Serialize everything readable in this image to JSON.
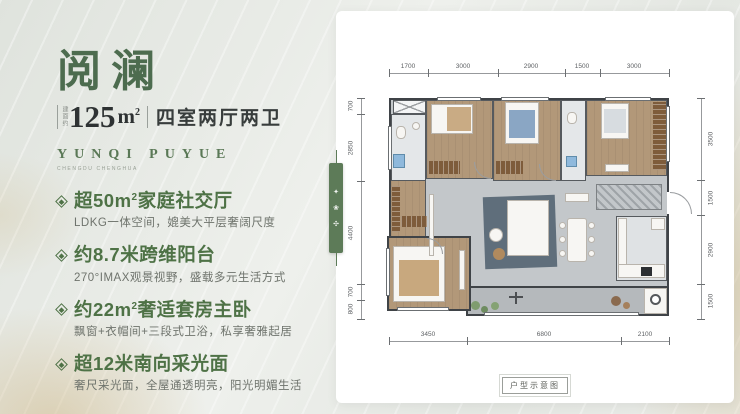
{
  "colors": {
    "accent_green": "#4e7246",
    "title_green": "#4d6c4f",
    "tab_green": "#5d7b58",
    "gold": "#c6a86c",
    "wood_floor": "#b29879",
    "living_gray": "#c3c7ca",
    "balcony_gray": "#b5b9bc",
    "wall_dark": "#3f4347"
  },
  "left_panel": {
    "title": "阅澜",
    "area_prefix": "建面约",
    "area_value": "125",
    "area_unit": "m",
    "area_sup": "2",
    "rooms_text": "四室两厅两卫",
    "subtitle_en": "YUNQI PUYUE",
    "subtitle_sub": "CHENGDU CHENGHUA",
    "features": [
      {
        "t1": "超50m",
        "sup": "2",
        "t2": "家庭社交厅",
        "desc": "LDKG一体空间，媲美大平层奢阔尺度"
      },
      {
        "t1": "约8.7米跨维阳台",
        "sup": "",
        "t2": "",
        "desc": "270°IMAX观景视野，盛载多元生活方式"
      },
      {
        "t1": "约22m",
        "sup": "2",
        "t2": "奢适套房主卧",
        "desc": "飘窗+衣帽间+三段式卫浴，私享奢雅起居"
      },
      {
        "t1": "超12米南向采光面",
        "sup": "",
        "t2": "",
        "desc": "奢尺采光面，全屋通透明亮，阳光明媚生活"
      }
    ]
  },
  "floorplan": {
    "caption": "户型示意图",
    "dims_top": [
      "1700",
      "3000",
      "2900",
      "1500",
      "3000"
    ],
    "dims_left": [
      "700",
      "2850",
      "4400",
      "700",
      "800"
    ],
    "dims_right": [
      "3500",
      "1500",
      "2900",
      "1500"
    ],
    "dims_bottom": [
      "3450",
      "6800",
      "2100"
    ],
    "side_tab_glyphs": [
      "✦",
      "❀",
      "✣"
    ]
  }
}
